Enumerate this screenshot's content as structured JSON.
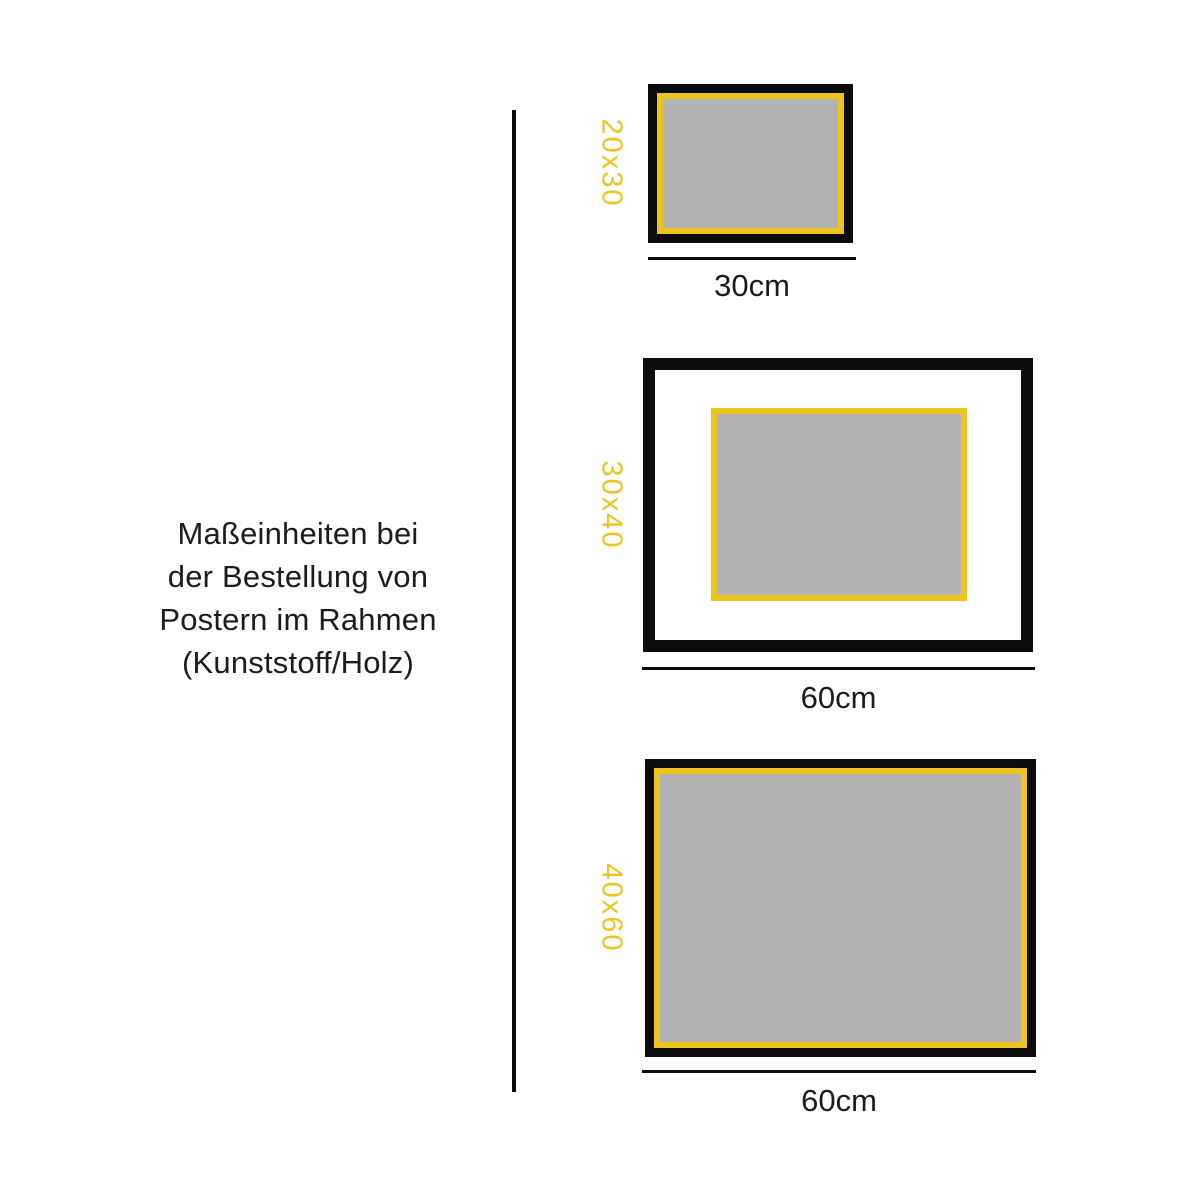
{
  "description_panel": {
    "lines": [
      "Maßeinheiten bei",
      "der Bestellung von",
      "Postern im Rahmen",
      "(Kunststoff/Holz)"
    ]
  },
  "frames": [
    {
      "size_label": "20x30",
      "width_label": "30cm",
      "style": "black frame, yellow inner edge, gray poster"
    },
    {
      "size_label": "30x40",
      "width_label": "60cm",
      "style": "black frame, white mat, yellow-edged gray poster"
    },
    {
      "size_label": "40x60",
      "width_label": "60cm",
      "style": "black frame, yellow inner edge, gray poster"
    }
  ],
  "colors": {
    "accent_yellow": "#edc41f",
    "poster_gray": "#b2b2b2",
    "ink_black": "#0c0c0c"
  }
}
